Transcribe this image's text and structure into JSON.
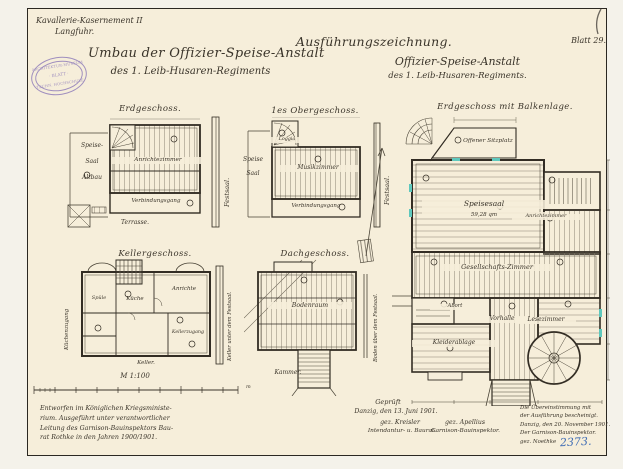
{
  "colors": {
    "paper": "#f6eeda",
    "ink": "#3a342a",
    "stamp_purple": "#8a77b8",
    "archive_blue": "#3f6cb4",
    "window_cyan": "#5ec8bd"
  },
  "header": {
    "office_line1": "Kavallerie-Kasernement II",
    "office_line2": "Langfuhr.",
    "title_line1": "Umbau der Offizier-Speise-Anstalt",
    "title_line2": "des 1. Leib-Husaren-Regiments",
    "drawing_type": "Ausführungszeichnung.",
    "subject_line1": "Offizier-Speise-Anstalt",
    "subject_line2": "des 1. Leib-Husaren-Regiments.",
    "sheet_number": "Blatt 29.",
    "corner_mark": "1"
  },
  "stamp": {
    "arc_top": "ARCHITEKTUR-MUSEUM",
    "middle": "· BLATT ·",
    "arc_bottom": "TECHN. HOCHSCHULE"
  },
  "plans": {
    "erdgeschoss": {
      "title": "Erdgeschoss.",
      "room_speise": "Speise-",
      "room_saal": "Saal",
      "room_altbau": "Altbau",
      "room_anrichtezimmer": "Anrichtezimmer",
      "room_verbindungsgang": "Verbindungsgang",
      "room_terrasse": "Terrasse.",
      "wall_festsaal": "Festsaal."
    },
    "obergeschoss": {
      "title": "1es Obergeschoss.",
      "room_speise": "Speise",
      "room_saal": "Saal",
      "room_loggia": "Loggia",
      "room_musikzimmer": "Musikzimmer",
      "room_verbindungsgang": "Verbindungsgang",
      "wall_festsaal": "Festsaal."
    },
    "kellergeschoss": {
      "title": "Kellergeschoss.",
      "room_spuele": "Spüle",
      "room_kueche": "Küche",
      "room_anrichte": "Anrichte",
      "room_kellerzugang": "Kellerzugang",
      "room_keller": "Keller.",
      "wall_keller_festsaal": "Keller unter dem Festsaal.",
      "wall_kuechenzugang": "Küchenzugang"
    },
    "dachgeschoss": {
      "title": "Dachgeschoss.",
      "room_bodenraum": "Bodenraum",
      "room_kammer": "Kammer.",
      "wall_boden_festsaal": "Boden über dem Festsaal."
    },
    "balkenlage": {
      "title": "Erdgeschoss mit Balkenlage.",
      "room_sitzplatz": "Offener Sitzplatz",
      "room_speisesaal": "Speisesaal",
      "area_speisesaal": "59,28 qm",
      "room_anrichtezimmer": "Anrichtezimmer",
      "room_gesellschaftszimmer": "Gesellschafts-Zimmer",
      "room_abort": "Abort",
      "room_kleiderablage": "Kleiderablage",
      "room_vorhalle": "Vorhalle",
      "room_lesezimmer": "Lesezimmer"
    }
  },
  "scale": {
    "label": "M 1:100",
    "unit": "m"
  },
  "approval": {
    "checked": "Geprüft",
    "place_date": "Danzig, den 13. Juni 1901.",
    "signature_left": "gez. Kreisler",
    "signature_right": "gez. Apellius",
    "title_left": "Intendantur- u. Baurat.",
    "title_right": "Garnison-Bauinspektor."
  },
  "notes": {
    "left_lines": [
      "Entworfen im Königlichen Kriegsministe-",
      "rium. Ausgeführt unter verantwortlicher",
      "Leitung des Garnison-Bauinspektors Bau-",
      "rat Rothke in den Jahren 1900/1901."
    ],
    "right_lines": [
      "Die Übereinstimmung mit",
      "der Ausführung bescheinigt.",
      "Danzig, den 20. November 1901.",
      "Der Garnison-Bauinspektor.",
      "gez. Noethke"
    ],
    "archive_number": "2373."
  }
}
